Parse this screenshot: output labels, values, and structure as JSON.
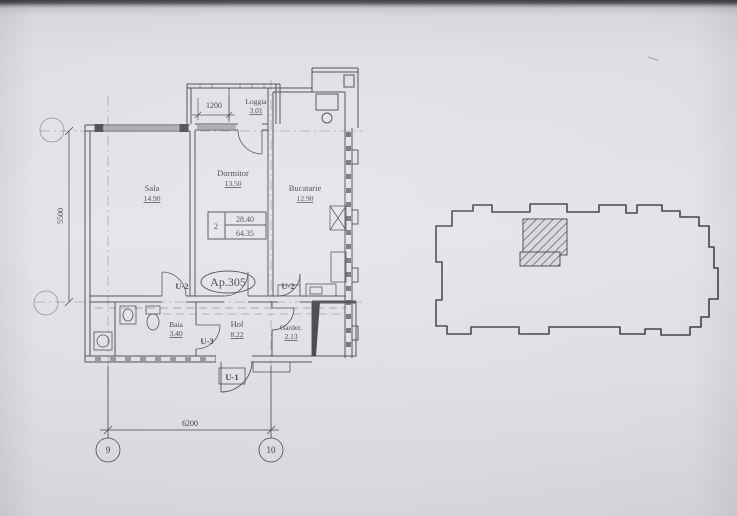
{
  "plan": {
    "apartment_id": "Ap.305",
    "spec_box": {
      "rooms": "2",
      "living_area": "28.40",
      "total_area": "64.35"
    },
    "rooms": {
      "sala": {
        "name": "Sala",
        "area": "14.90"
      },
      "dormitor": {
        "name": "Dormitor",
        "area": "13.50"
      },
      "bucatarie": {
        "name": "Bucatarie",
        "area": "12.90"
      },
      "loggia": {
        "name": "Loggia",
        "area": "3.01"
      },
      "baia": {
        "name": "Baia",
        "area": "3.40"
      },
      "hol": {
        "name": "Hol",
        "area": "8.22"
      },
      "garderoba": {
        "name": "Garder.",
        "area": "2.13"
      }
    },
    "door_labels": {
      "entrance": "U-1",
      "sala_door": "U-2",
      "bucatarie_door": "U-2",
      "baie_door": "U-3"
    },
    "dimensions": {
      "vertical": "5500",
      "horizontal": "6200",
      "loggia": "1200"
    },
    "axes": {
      "bottom_left": "9",
      "bottom_right": "10"
    }
  },
  "colors": {
    "paper": "#dfdee5",
    "ink": "#45454d"
  }
}
